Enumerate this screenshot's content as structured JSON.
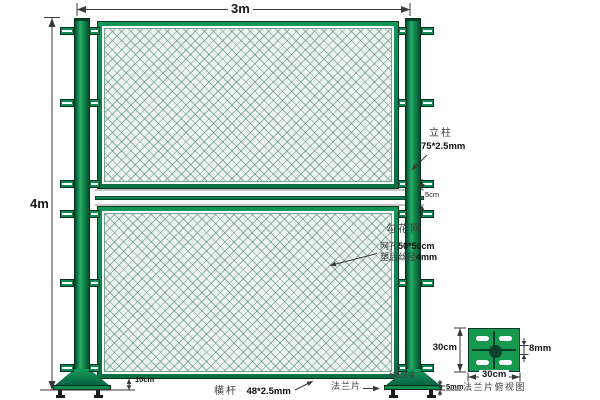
{
  "dims": {
    "width": "3m",
    "height": "4m",
    "gap": "5cm",
    "ground_clearance": "10cm",
    "plate_thickness": "5mm"
  },
  "post": {
    "label": "立柱",
    "spec": "75*2.5mm"
  },
  "mesh": {
    "label": "勾花网",
    "aperture_label": "网孔",
    "aperture_value": "50*50cm",
    "wire_label": "塑后丝径",
    "wire_value": "4mm"
  },
  "rail": {
    "label": "横杆",
    "spec": "48*2.5mm"
  },
  "flange": {
    "label": "法兰片",
    "support_label": "加固支撑"
  },
  "flange_detail": {
    "width": "30cm",
    "height": "30cm",
    "hole": "8mm",
    "caption": "法兰片俯视图"
  },
  "colors": {
    "post_green": "#0f8a50",
    "dark_green": "#05402a",
    "mesh_fill": "#eef3f0",
    "mesh_line": "#6f9c8c",
    "plate_green": "#17984f",
    "dimension_line": "#3a3a3a"
  }
}
